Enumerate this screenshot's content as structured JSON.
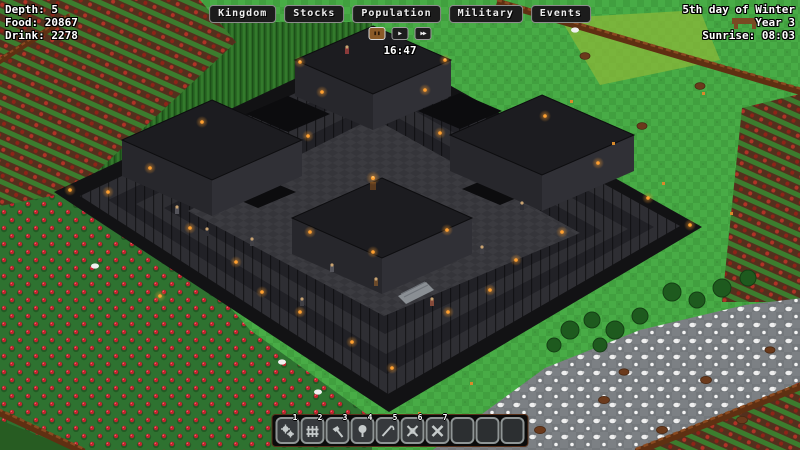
{
  "hud": {
    "depth": "Depth: 5",
    "food": "Food: 20867",
    "drink": "Drink: 2278",
    "date": "5th day of Winter",
    "year": "Year 3",
    "sunrise": "Sunrise: 08:03",
    "clock": "16:47"
  },
  "menu": {
    "kingdom": "Kingdom",
    "stocks": "Stocks",
    "population": "Population",
    "military": "Military",
    "events": "Events"
  },
  "playback": {
    "pause_glyph": "▮▮",
    "play_glyph": "▶",
    "ffwd_glyph": "▶▶",
    "active": "pause"
  },
  "toolbar": {
    "slots": [
      {
        "num": "1",
        "icon": "gears-icon"
      },
      {
        "num": "2",
        "icon": "fence-icon"
      },
      {
        "num": "3",
        "icon": "hammer-icon"
      },
      {
        "num": "4",
        "icon": "tree-icon"
      },
      {
        "num": "5",
        "icon": "scythe-icon"
      },
      {
        "num": "6",
        "icon": "cancel-build-icon"
      },
      {
        "num": "7",
        "icon": "clear-icon"
      },
      {
        "num": "",
        "icon": ""
      },
      {
        "num": "",
        "icon": ""
      },
      {
        "num": "",
        "icon": ""
      }
    ]
  },
  "colors": {
    "torch": "#ffa030",
    "grass": "#41a03f",
    "stone_dark": "#1d1d21",
    "fence_brown": "#5f3012",
    "berry_red": "#c1242f",
    "accent_active": "#8a5a28"
  }
}
